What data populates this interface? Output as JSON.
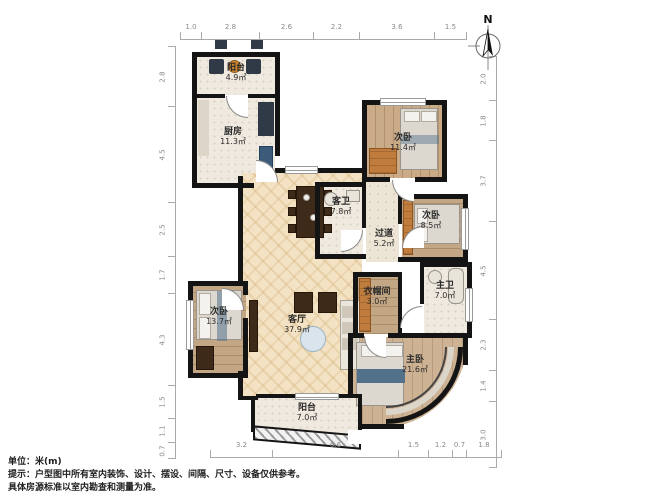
{
  "compass": {
    "label": "N"
  },
  "rooms": {
    "balcony_top": {
      "name": "阳台",
      "area": "4.9㎡"
    },
    "kitchen": {
      "name": "厨房",
      "area": "11.3㎡"
    },
    "bedroom_tr": {
      "name": "次卧",
      "area": "11.4㎡"
    },
    "bath_guest": {
      "name": "客卫",
      "area": "7.8㎡"
    },
    "hallway": {
      "name": "过道",
      "area": "5.2㎡"
    },
    "bedroom_right": {
      "name": "次卧",
      "area": "8.5㎡"
    },
    "bath_master": {
      "name": "主卫",
      "area": "7.0㎡"
    },
    "cloakroom": {
      "name": "衣帽间",
      "area": "3.0㎡"
    },
    "living": {
      "name": "客厅",
      "area": "37.9㎡"
    },
    "bedroom_left": {
      "name": "次卧",
      "area": "13.7㎡"
    },
    "bedroom_master": {
      "name": "主卧",
      "area": "21.6㎡"
    },
    "balcony_bottom": {
      "name": "阳台",
      "area": "7.0㎡"
    }
  },
  "dims": {
    "top": [
      "1.0",
      "2.8",
      "2.6",
      "2.2",
      "3.6",
      "1.5"
    ],
    "bottom": [
      "3.2",
      "6.6",
      "1.5",
      "1.2",
      "0.7",
      "1.8"
    ],
    "left": [
      "2.8",
      "4.5",
      "2.5",
      "1.7",
      "4.3",
      "1.5",
      "1.1",
      "0.7"
    ],
    "right": [
      "2.0",
      "1.8",
      "3.7",
      "4.5",
      "2.3",
      "1.4",
      "3.0"
    ]
  },
  "notes": {
    "line1": "单位：米(m)",
    "line2": "提示：户型图中所有室内装饰、设计、摆设、间隔、尺寸、设备仅供参考。",
    "line3": "具体房源标准以室内勘查和测量为准。"
  },
  "colors": {
    "wall": "#141414",
    "wood_floor": "#c9ab87",
    "tile_floor": "#efe9df",
    "living_floor": "#f3e2c3",
    "wardrobe_orange": "#c07c3c",
    "bedding_blue": "#54718c",
    "dim_text": "#8a8a8a"
  }
}
